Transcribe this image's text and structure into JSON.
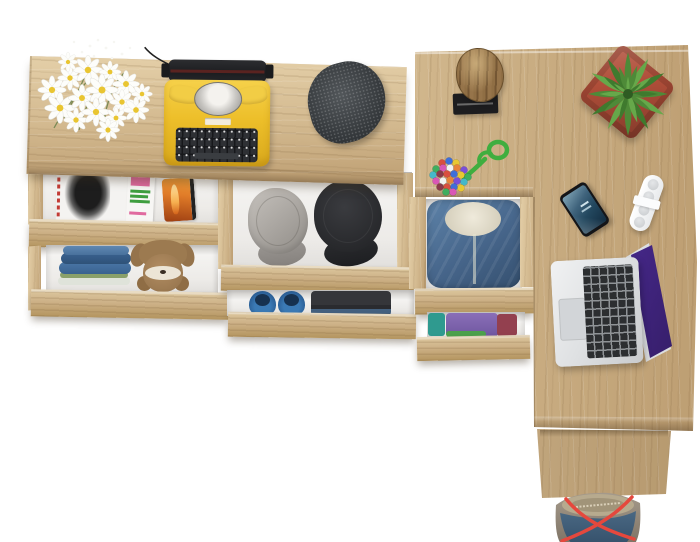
{
  "scene": {
    "description": "Top view of a light oak corner desk and sideboard with open drawers holding clothes and accessories",
    "background": "#ffffff"
  },
  "palette": {
    "oak_highlight": "#e4cfa8",
    "oak_mid": "#d2b88e",
    "oak_shadow": "#bd9e72",
    "oak_front": "#cdb187",
    "typewriter_yellow": "#f0c431",
    "typewriter_dark": "#232427",
    "flat_cap_charcoal": "#3e4347",
    "gray_cap": "#b4b0ab",
    "black_cap": "#2c2d30",
    "denim_hoodie": "#46658a",
    "fleece": "#eae5d6",
    "jeans_blue": "#4a76a6",
    "teddy_brown": "#a8835a",
    "shoe_blue": "#2e6ca6",
    "log_brown": "#8a6a40",
    "pot_red": "#b04e39",
    "rope_green": "#3fae3f",
    "daisy_center": "#e9c531",
    "stem_green": "#7a8a55",
    "laptop_silver": "#dfe1e3",
    "screen_pink": "#e160c8",
    "phone_screen_blue": "#2c4f68",
    "case_orange": "#e07b28",
    "bag_red_strap": "#e5483d",
    "bag_denim": "#3e5a74",
    "bag_taupe": "#96897a"
  },
  "sideboard": {
    "top_items": [
      {
        "name": "daisy-bouquet",
        "label": "bunch of white daisies"
      },
      {
        "name": "typewriter",
        "label": "yellow vintage typewriter with black keys"
      },
      {
        "name": "flat-cap",
        "label": "charcoal tweed flat cap"
      }
    ],
    "drawers": [
      {
        "name": "magazines-drawer",
        "contents": [
          "black and white fashion magazine",
          "magazine with pink and green cover",
          "orange smartphone case"
        ]
      },
      {
        "name": "jeans-drawer",
        "contents": [
          "stack of folded jeans",
          "brown teddy bear"
        ]
      },
      {
        "name": "caps-drawer",
        "contents": [
          "gray patrol cap",
          "black patrol cap"
        ]
      },
      {
        "name": "shoes-drawer",
        "contents": [
          "pair of blue slip-on shoes",
          "folded dark clothes"
        ]
      }
    ]
  },
  "desk": {
    "top_items": [
      {
        "name": "log-decor",
        "label": "raw wooden log on black stand"
      },
      {
        "name": "succulent-plant",
        "label": "green succulent in red square pot"
      },
      {
        "name": "bead-necklace",
        "label": "multicolored bead ball with green cord loop"
      },
      {
        "name": "smartphone",
        "label": "smartphone with dark blue screen"
      },
      {
        "name": "white-charger",
        "label": "white charger block with round sockets"
      },
      {
        "name": "laptop",
        "label": "open silver laptop with pink-purple wallpaper"
      }
    ],
    "bead_necklace": {
      "cord_color": "#3fae3f",
      "bead_colors": [
        "#d94f3f",
        "#3f6fd9",
        "#e8c832",
        "#3fae5f",
        "#d957b5",
        "#f2f2f2",
        "#e8833a",
        "#7a4fd9",
        "#45b8c9",
        "#8a3a4a"
      ]
    },
    "plant": {
      "pot_color": "#b04e39",
      "leaf_colors": [
        "#4e8a38",
        "#66a84a",
        "#3f7a2e"
      ]
    },
    "drawers": [
      {
        "name": "hoodie-drawer",
        "contents": [
          "blue denim hoodie with fleece lining"
        ]
      },
      {
        "name": "folded-clothes-drawer",
        "contents": [
          "teal shirt",
          "purple shirt",
          "green shirt",
          "maroon shirt"
        ]
      }
    ]
  },
  "floor_items": [
    {
      "name": "tote-bag",
      "label": "denim and taupe tote bag with red straps"
    }
  ]
}
